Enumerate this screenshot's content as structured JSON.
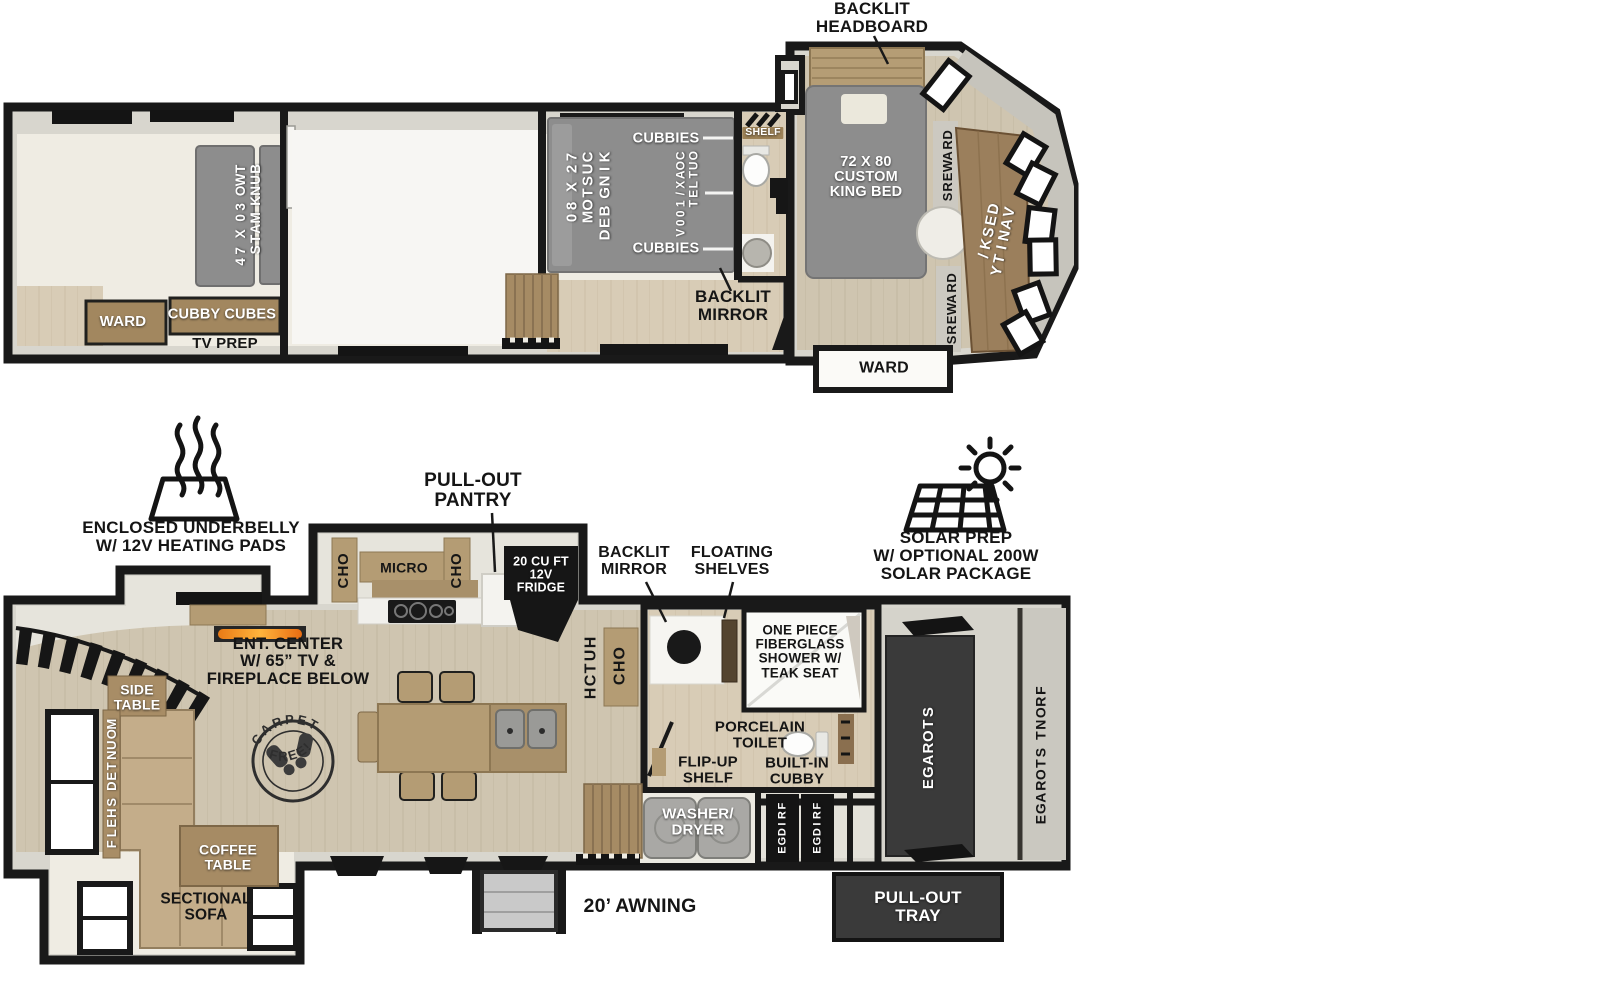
{
  "colors": {
    "wall": "#191919",
    "wood_floor": "#cfc5b0",
    "cabinet_wood": "#a2875f",
    "bed_gray": "#8d8d8d",
    "dark_box": "#3a3a3a",
    "appliance_black": "#141414",
    "flame_orange": "#f59a2c",
    "cream": "#efece3"
  },
  "upper_plan": {
    "backlit_headboard": "BACKLIT\nHEADBOARD",
    "bunk_room": {
      "bunk_mats": "TWO 30 X 74\nBUNK MATS",
      "ward": "WARD",
      "cubby_cubes": "CUBBY CUBES",
      "tv_prep": "TV PREP"
    },
    "mid_bedroom": {
      "bed": "72 X 80\nCUSTOM\nKING BED",
      "cubbies_top": "CUBBIES",
      "coax_outlet": "COAX/100V\nOUTLET",
      "cubbies_bottom": "CUBBIES"
    },
    "bathroom": {
      "shelf": "SHELF",
      "backlit_mirror": "BACKLIT\nMIRROR"
    },
    "front_bedroom": {
      "bed": "72 X 80\nCUSTOM\nKING BED",
      "drawers_top": "DRAWERS",
      "desk_vanity": "DESK/\nVANITY",
      "drawers_bottom": "DRAWERS",
      "ward": "WARD"
    }
  },
  "lower_plan": {
    "callouts": {
      "underbelly": "ENCLOSED UNDERBELLY\nW/ 12V HEATING PADS",
      "pantry": "PULL-OUT\nPANTRY",
      "solar": "SOLAR PREP\nW/ OPTIONAL 200W\nSOLAR PACKAGE",
      "awning": "20’ AWNING"
    },
    "kitchen": {
      "ohc_left": "OHC",
      "micro": "MICRO",
      "ohc_right": "OHC",
      "fridge": "20 CU FT\n12V\nFRIDGE",
      "hutch": "HUTCH",
      "ohc_hutch": "OHC"
    },
    "bath": {
      "backlit_mirror": "BACKLIT\nMIRROR",
      "floating_shelves": "FLOATING\nSHELVES",
      "shower": "ONE PIECE\nFIBERGLASS\nSHOWER W/\nTEAK SEAT",
      "toilet": "PORCELAIN\nTOILET",
      "flip_up_shelf": "FLIP-UP\nSHELF",
      "built_in_cubby": "BUILT-IN\nCUBBY"
    },
    "living": {
      "side_table": "SIDE\nTABLE",
      "mounted_shelf": "MOUNTED SHELF",
      "coffee_table": "COFFEE\nTABLE",
      "sectional_sofa": "SECTIONAL\nSOFA",
      "ent_center": "ENT. CENTER\nW/ 65” TV &\nFIREPLACE BELOW",
      "carpet_top": "CARPET",
      "carpet_bottom": "FREE!"
    },
    "utility": {
      "washer_dryer": "WASHER/\nDRYER",
      "fridge_left": "FRIDGE",
      "fridge_right": "FRIDGE"
    },
    "storage": {
      "storage": "STORAGE",
      "front_storage": "FRONT STORAGE",
      "pull_out_tray": "PULL-OUT\nTRAY"
    }
  }
}
